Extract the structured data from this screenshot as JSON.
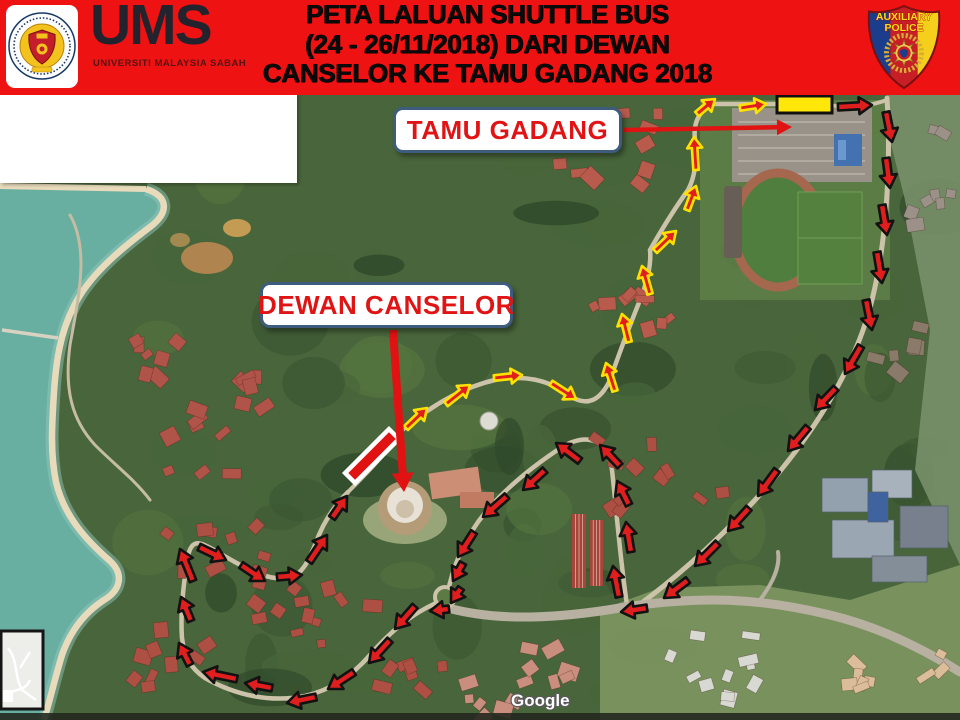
{
  "title": {
    "lines": [
      "PETA LALUAN SHUTTLE BUS",
      "(24 - 26/11/2018) DARI DEWAN",
      "CANSELOR KE TAMU GADANG 2018"
    ]
  },
  "logo": {
    "acronym": "UMS",
    "subtitle": "UNIVERSITI MALAYSIA SABAH"
  },
  "badge": {
    "line1": "AUXILIARY",
    "line2": "POLICE"
  },
  "colors": {
    "header_bg": "#EE1212",
    "route_fill": "#E01E1E",
    "loop_outline": "#121212",
    "tamu_outline": "#FFE100",
    "label_border": "#3D5C7E",
    "label_text": "#E01414",
    "pointer_red": "#E01212",
    "destination_fill": "#FFE70A"
  },
  "map": {
    "watermark": "Google",
    "labels": [
      {
        "id": "tamu-gadang",
        "text": "TAMU GADANG",
        "x": 393,
        "y": 107,
        "w": 229,
        "h": 46
      },
      {
        "id": "dewan-canselor",
        "text": "DEWAN CANSELOR",
        "x": 260,
        "y": 282,
        "w": 253,
        "h": 46
      }
    ],
    "routes": {
      "shuttle_loop": {
        "outline": "#121212",
        "fill": "#E01E1E",
        "arrows": [
          [
            838,
            107,
            872,
            105
          ],
          [
            886,
            112,
            892,
            142
          ],
          [
            886,
            158,
            890,
            188
          ],
          [
            882,
            205,
            887,
            235
          ],
          [
            877,
            252,
            882,
            283
          ],
          [
            866,
            300,
            872,
            330
          ],
          [
            861,
            346,
            845,
            374
          ],
          [
            836,
            388,
            815,
            410
          ],
          [
            808,
            427,
            788,
            451
          ],
          [
            777,
            470,
            758,
            496
          ],
          [
            749,
            508,
            728,
            531
          ],
          [
            718,
            543,
            695,
            566
          ],
          [
            688,
            580,
            664,
            598
          ],
          [
            647,
            608,
            621,
            612
          ],
          [
            619,
            597,
            613,
            566
          ],
          [
            631,
            552,
            626,
            522
          ],
          [
            629,
            505,
            617,
            481
          ],
          [
            620,
            466,
            600,
            445
          ],
          [
            580,
            461,
            556,
            443
          ],
          [
            545,
            470,
            523,
            490
          ],
          [
            507,
            496,
            483,
            517
          ],
          [
            474,
            532,
            458,
            557
          ],
          [
            463,
            563,
            453,
            581
          ],
          [
            461,
            588,
            451,
            603
          ],
          [
            449,
            609,
            430,
            611
          ],
          [
            415,
            606,
            395,
            629
          ],
          [
            390,
            640,
            369,
            663
          ],
          [
            354,
            672,
            328,
            689
          ],
          [
            316,
            697,
            287,
            703
          ],
          [
            272,
            688,
            245,
            683
          ],
          [
            237,
            679,
            203,
            672
          ],
          [
            190,
            665,
            179,
            643
          ],
          [
            191,
            621,
            181,
            597
          ],
          [
            193,
            581,
            180,
            549
          ],
          [
            199,
            547,
            226,
            560
          ],
          [
            241,
            565,
            265,
            581
          ],
          [
            277,
            577,
            302,
            575
          ],
          [
            309,
            562,
            327,
            535
          ],
          [
            332,
            518,
            347,
            496
          ]
        ]
      },
      "canselor_to_tamu": {
        "outline": "#FFE100",
        "fill": "#E01E1E",
        "arrows": [
          [
            406,
            428,
            427,
            408
          ],
          [
            446,
            404,
            470,
            385
          ],
          [
            494,
            378,
            522,
            375
          ],
          [
            551,
            383,
            576,
            399
          ],
          [
            615,
            391,
            606,
            363
          ],
          [
            629,
            342,
            622,
            314
          ],
          [
            650,
            294,
            642,
            266
          ],
          [
            655,
            251,
            676,
            231
          ],
          [
            687,
            210,
            696,
            186
          ],
          [
            696,
            170,
            694,
            137
          ],
          [
            697,
            114,
            715,
            99
          ],
          [
            740,
            108,
            766,
            104
          ]
        ]
      }
    },
    "pointers": [
      {
        "name": "tamu-gadang-pointer",
        "from": [
          624,
          130
        ],
        "to": [
          792,
          127
        ],
        "shaft": 4.5,
        "head_w": 16,
        "head_l": 15
      },
      {
        "name": "dewan-canselor-pointer",
        "from": [
          393,
          330
        ],
        "to": [
          404,
          492
        ],
        "shaft": 8,
        "head_w": 22,
        "head_l": 19
      }
    ],
    "destination_box": {
      "x": 777,
      "y": 96,
      "w": 55,
      "h": 17
    },
    "start_marker": {
      "cx": 372,
      "cy": 456,
      "w": 62,
      "h": 14,
      "angle": -45
    }
  }
}
